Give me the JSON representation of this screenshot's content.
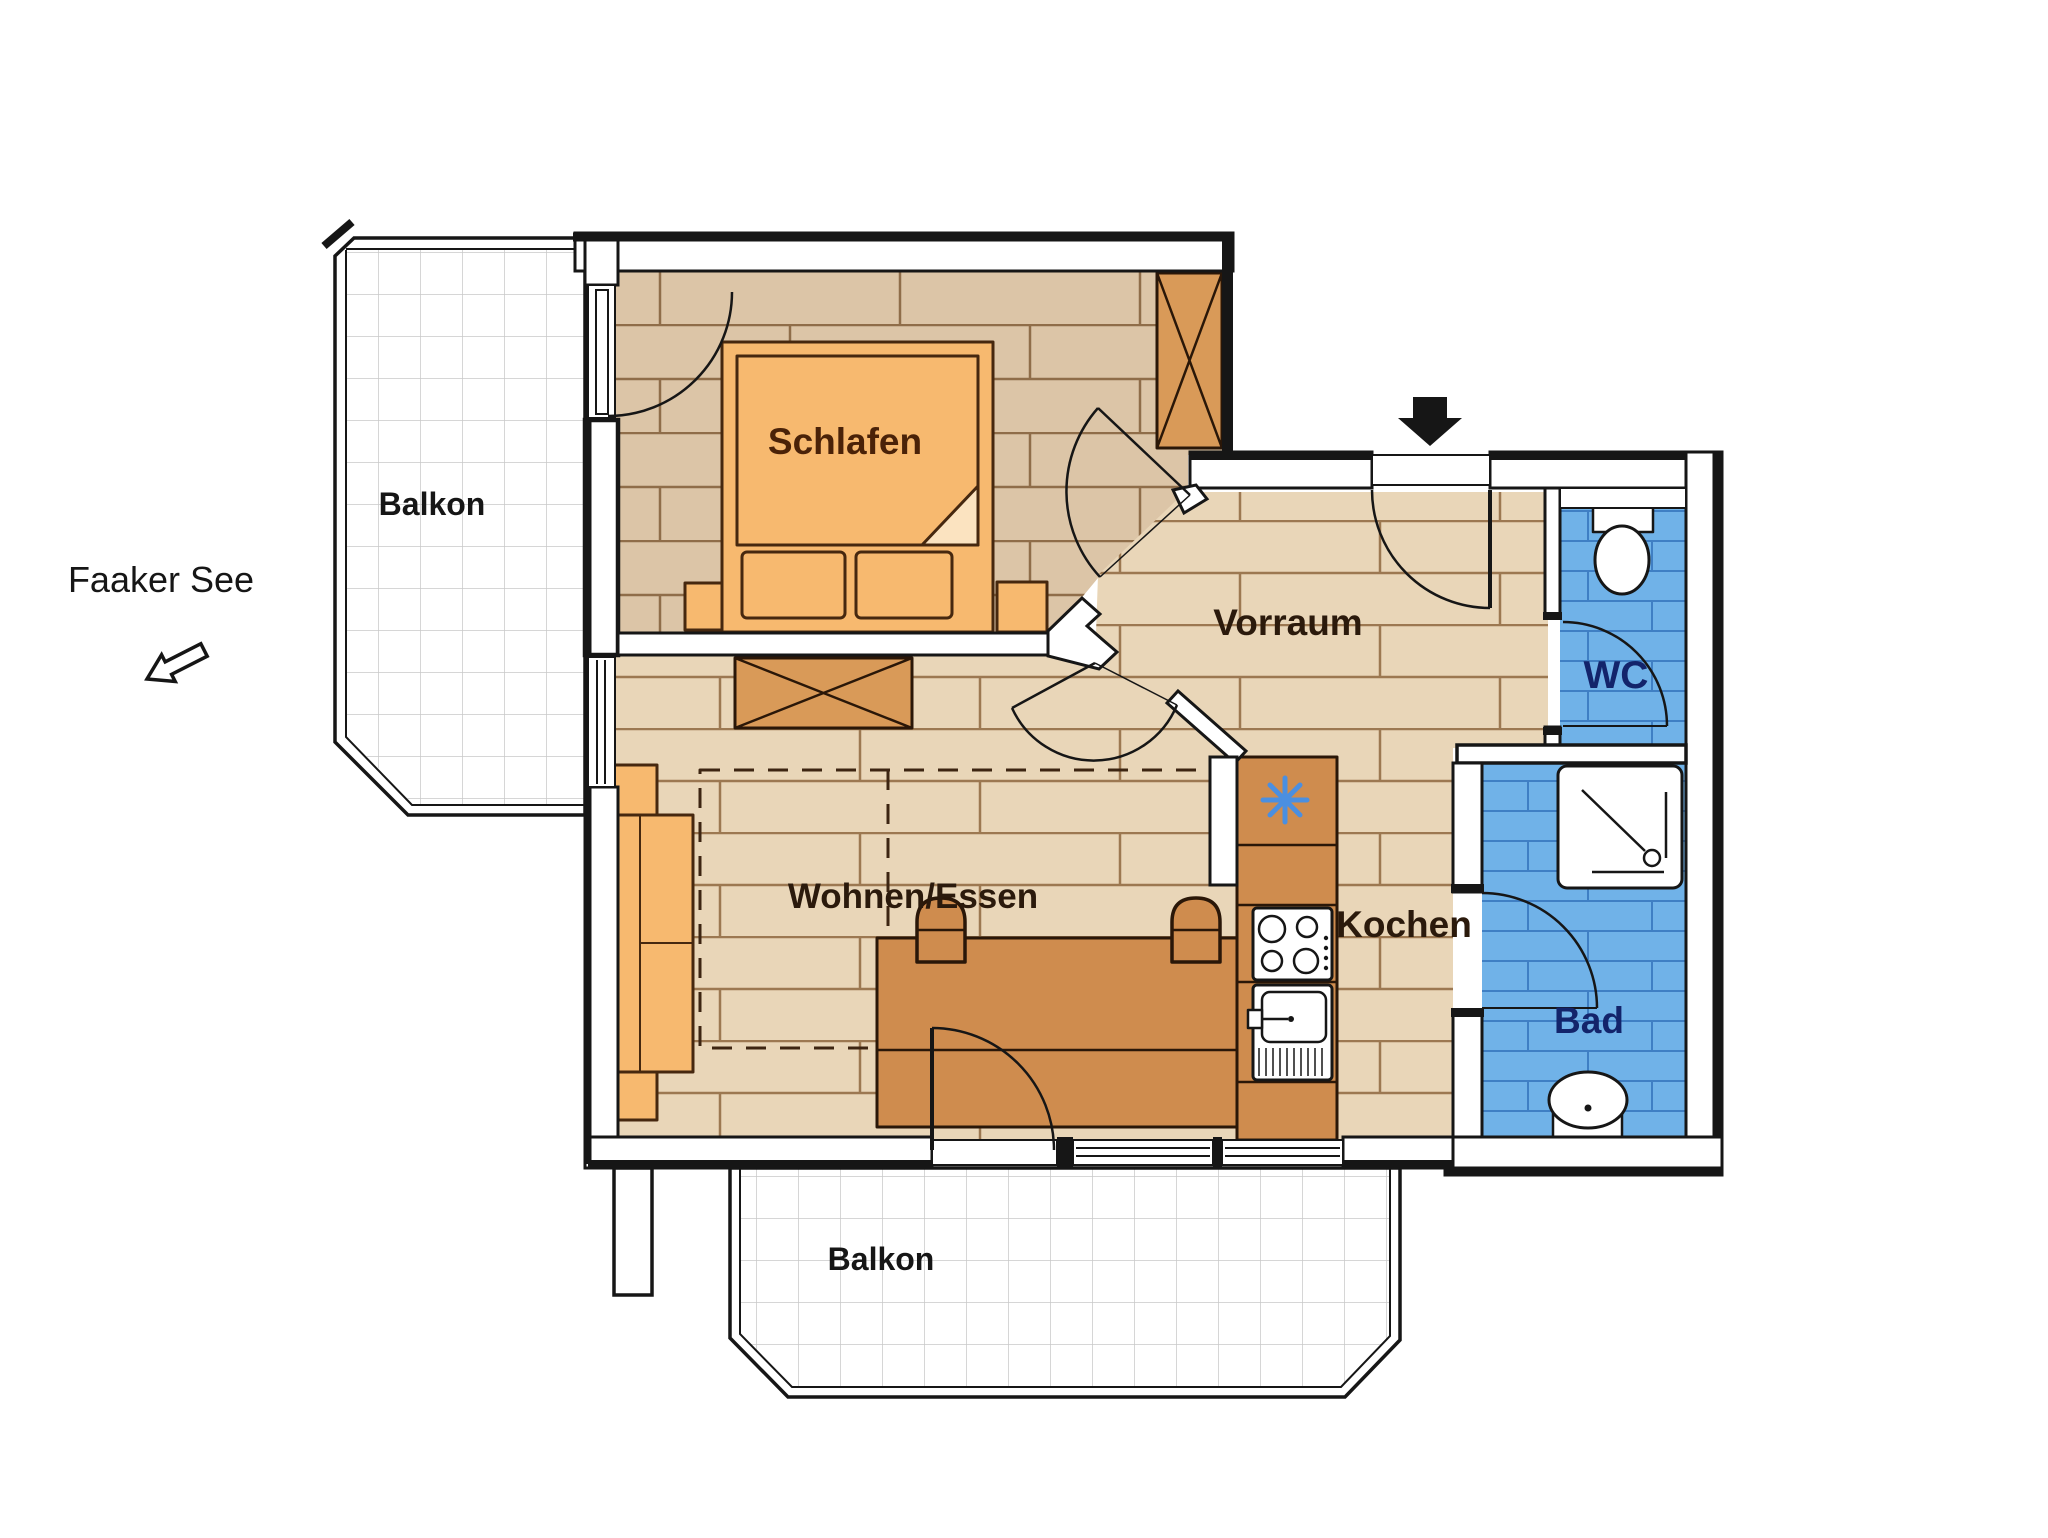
{
  "page": {
    "type": "apartment-floor-plan",
    "background": "#ffffff"
  },
  "labels": {
    "schlafen": "Schlafen",
    "vorraum": "Vorraum",
    "kochen": "Kochen",
    "wohnen_essen": "Wohnen/Essen",
    "wc": "WC",
    "bad": "Bad",
    "balkon_left": "Balkon",
    "balkon_bottom": "Balkon",
    "faaker_see": "Faaker See"
  },
  "colors": {
    "wall_fill": "#ffffff",
    "line": "#161616",
    "wood_bedroom": "#dcc5a7",
    "wood_main": "#e9d6b8",
    "plank_joint_bedroom": "#8f6d49",
    "plank_joint_main": "#9c7851",
    "furniture_light": "#f7b96f",
    "furniture_dark": "#cf8c4e",
    "tile_blue": "#70b2e8",
    "tile_blue_joint": "#3f7fc4",
    "balcony_tile_line": "#c9c9c9",
    "label_dark": "#2b1a0c",
    "label_bedroom": "#4a2208",
    "label_wet_room": "#13246b",
    "fridge_star": "#4b8fe0"
  },
  "icons": {
    "entrance_arrow": "solid black arrow marking apartment entrance",
    "lake_direction_arrow": "outlined arrow pointing southwest toward the lake",
    "fridge_star": "blue asterisk fridge symbol",
    "wardrobe_x": "crossed rectangle wardrobe symbol",
    "sideboard_x": "crossed rectangle sideboard symbol"
  },
  "fixtures": [
    "double bed with two pillows",
    "two nightstands",
    "wardrobe",
    "sideboard",
    "sofa",
    "dashed rug outline",
    "dining table",
    "two chairs",
    "kitchen counter",
    "fridge",
    "stove with four burners",
    "kitchen sink",
    "shower",
    "washbasin",
    "toilet"
  ]
}
